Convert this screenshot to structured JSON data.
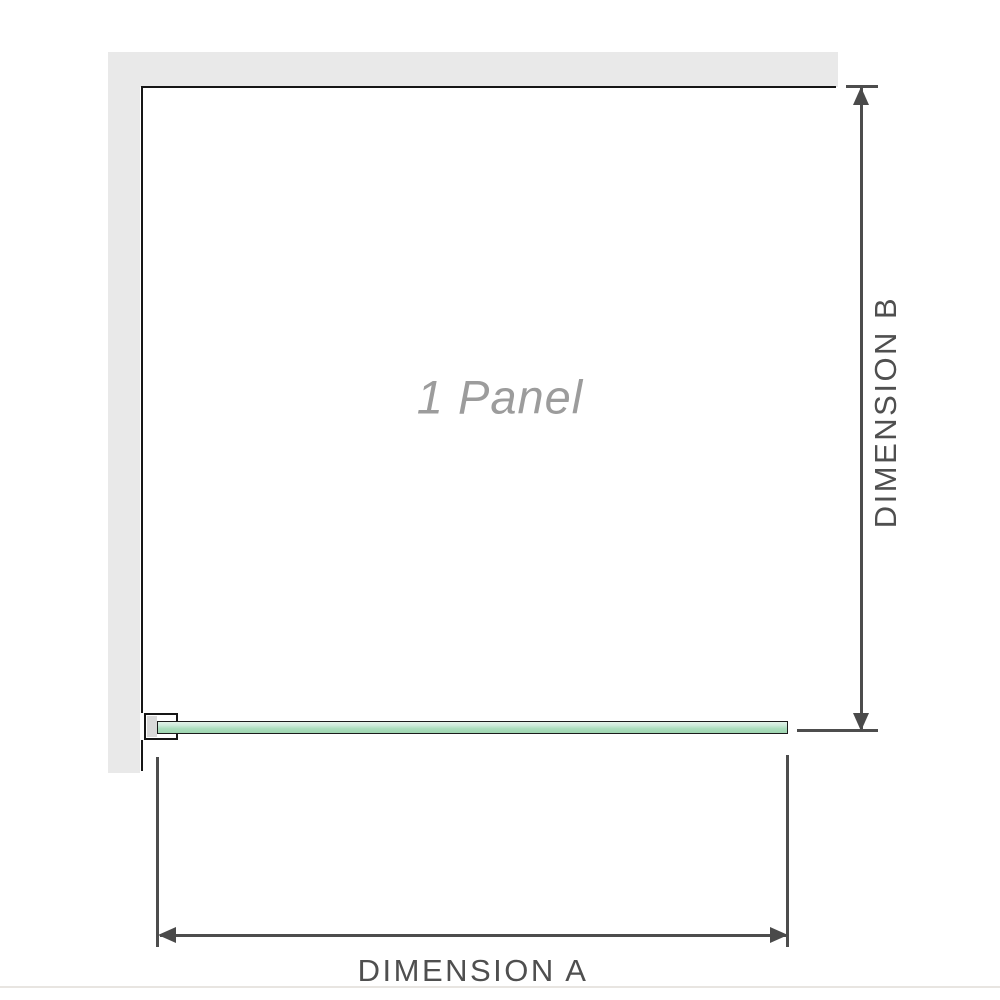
{
  "diagram": {
    "panel_label": "1 Panel",
    "dimensions": {
      "a_label": "DIMENSION A",
      "b_label": "DIMENSION B"
    },
    "colors": {
      "wall": "#e9e9e9",
      "outline": "#161616",
      "dimension_lines": "#4d4d4d",
      "dimension_label_text": "#4f4f4f",
      "panel_label_text": "#9c9c9c",
      "glass_top": "#e2f2e8",
      "glass_bottom": "#9fd5b0",
      "bracket_fill": "#d9d9d9",
      "background": "#ffffff"
    }
  }
}
